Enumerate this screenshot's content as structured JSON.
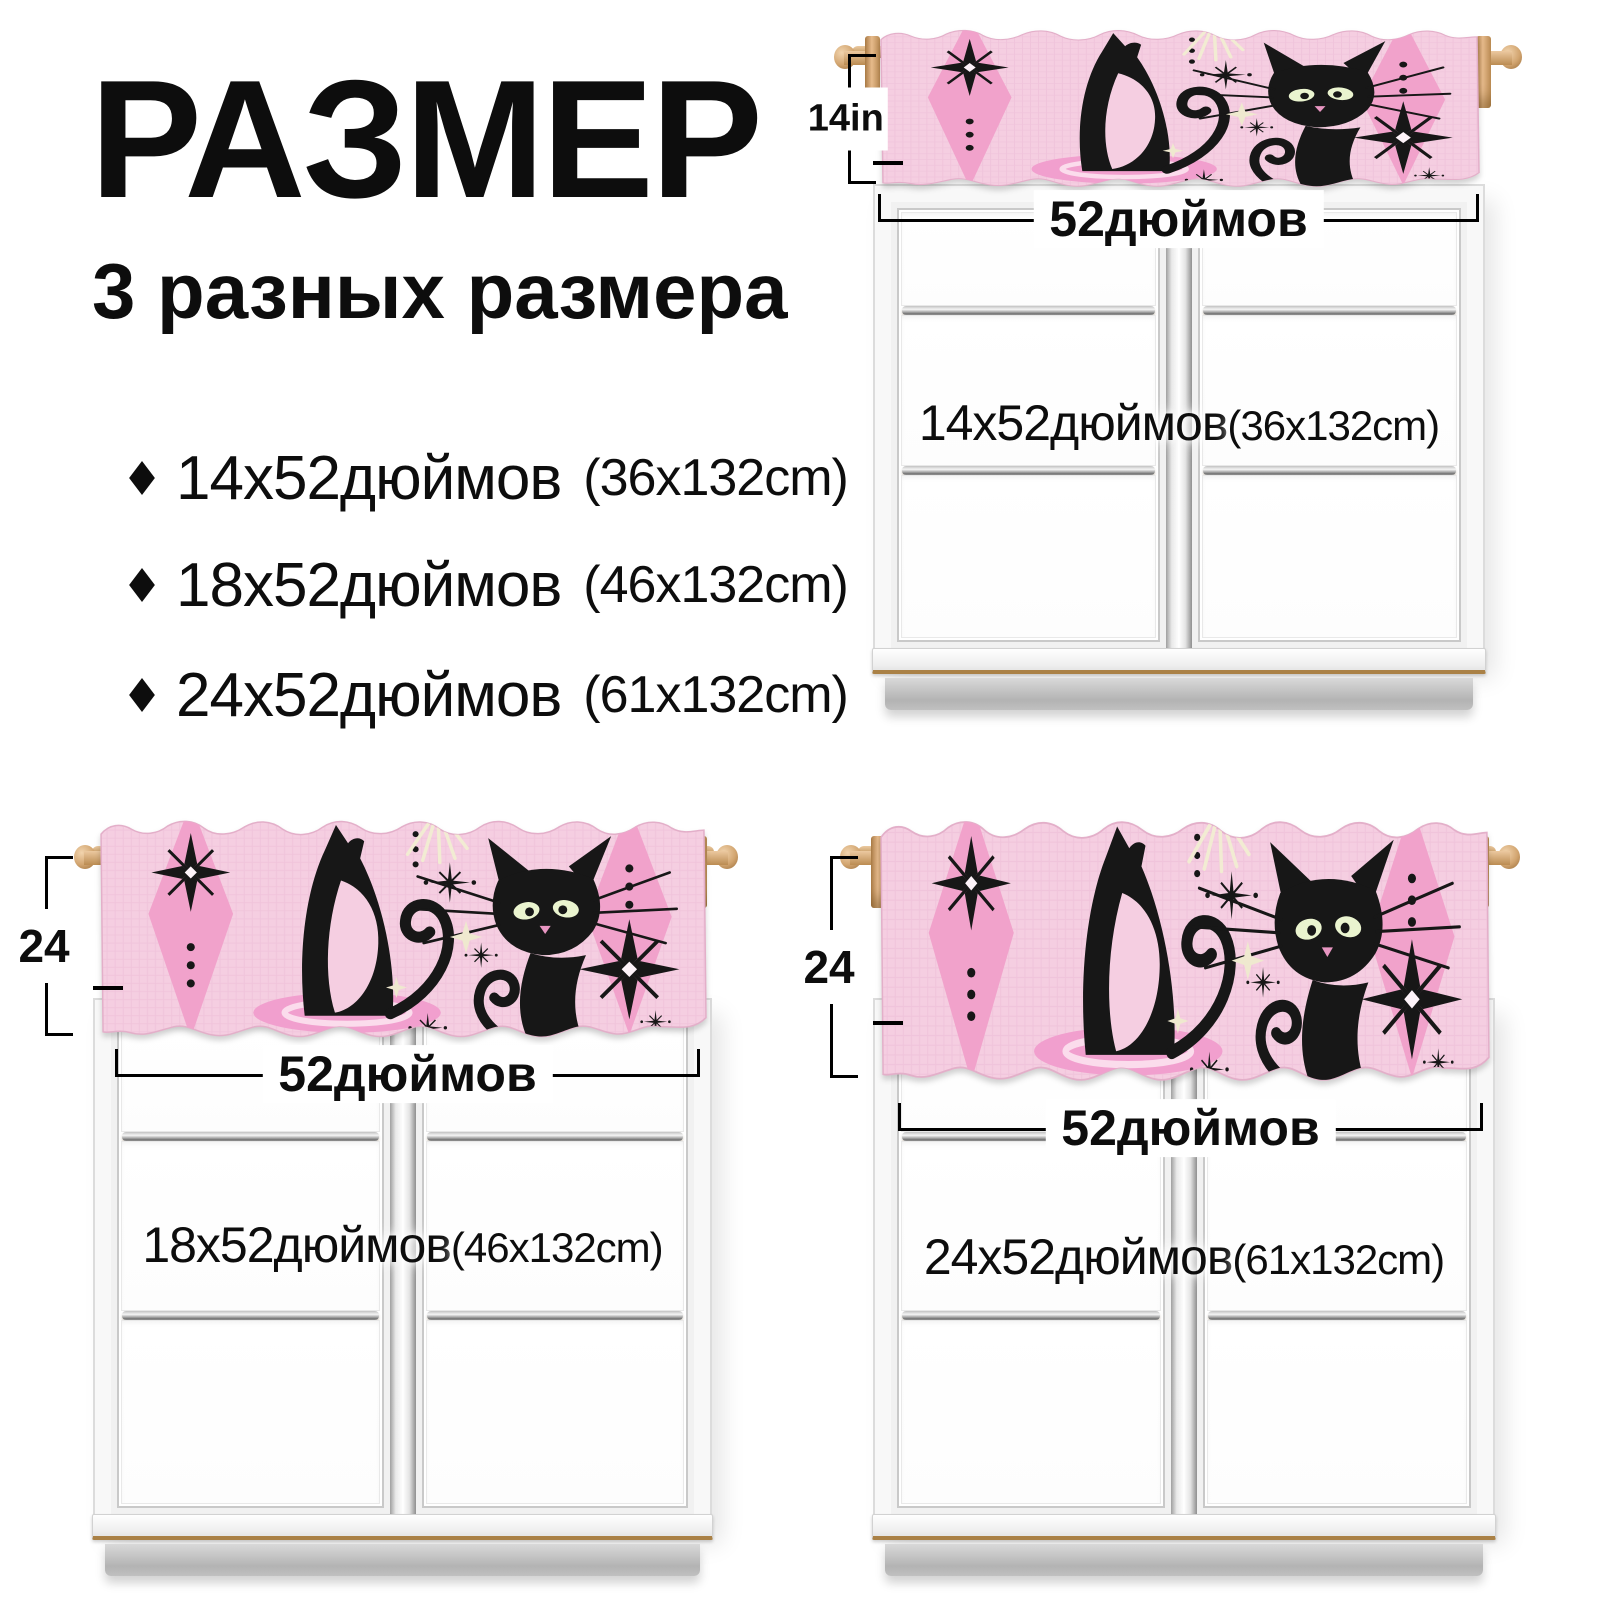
{
  "header": {
    "title": "РАЗМЕР",
    "subtitle": "3 разных размера"
  },
  "size_list": {
    "bullet_icon": "diamond",
    "items": [
      {
        "inches": "14x52дюймов",
        "metric": "(36x132cm)"
      },
      {
        "inches": "18x52дюймов",
        "metric": "(46x132cm)"
      },
      {
        "inches": "24x52дюймов",
        "metric": "(61x132cm)"
      }
    ]
  },
  "windows": [
    {
      "position": "top-right",
      "height_label": "14in",
      "width_label": "52дюймов",
      "overlay_inches": "14x52дюймов",
      "overlay_metric": "(36x132cm)"
    },
    {
      "position": "bottom-left",
      "height_label": "24",
      "width_label": "52дюймов",
      "overlay_inches": "18x52дюймов",
      "overlay_metric": "(46x132cm)"
    },
    {
      "position": "bottom-right",
      "height_label": "24",
      "width_label": "52дюймов",
      "overlay_inches": "24x52дюймов",
      "overlay_metric": "(61x132cm)"
    }
  ],
  "valance_art": {
    "description": "retro black atomic cats with pink diamonds and starbursts on pink woven fabric",
    "colors": {
      "fabric": "#f5cee1",
      "weave_line": "#ecbcd6",
      "diamond": "#f1a2cb",
      "puddle": "#f19fce",
      "cat": "#171717",
      "eyes": "#eaf4cf",
      "cream_star": "#efe9cf",
      "rod_wood": "#d9a876"
    }
  },
  "dimension_color": "#0d0d0d"
}
